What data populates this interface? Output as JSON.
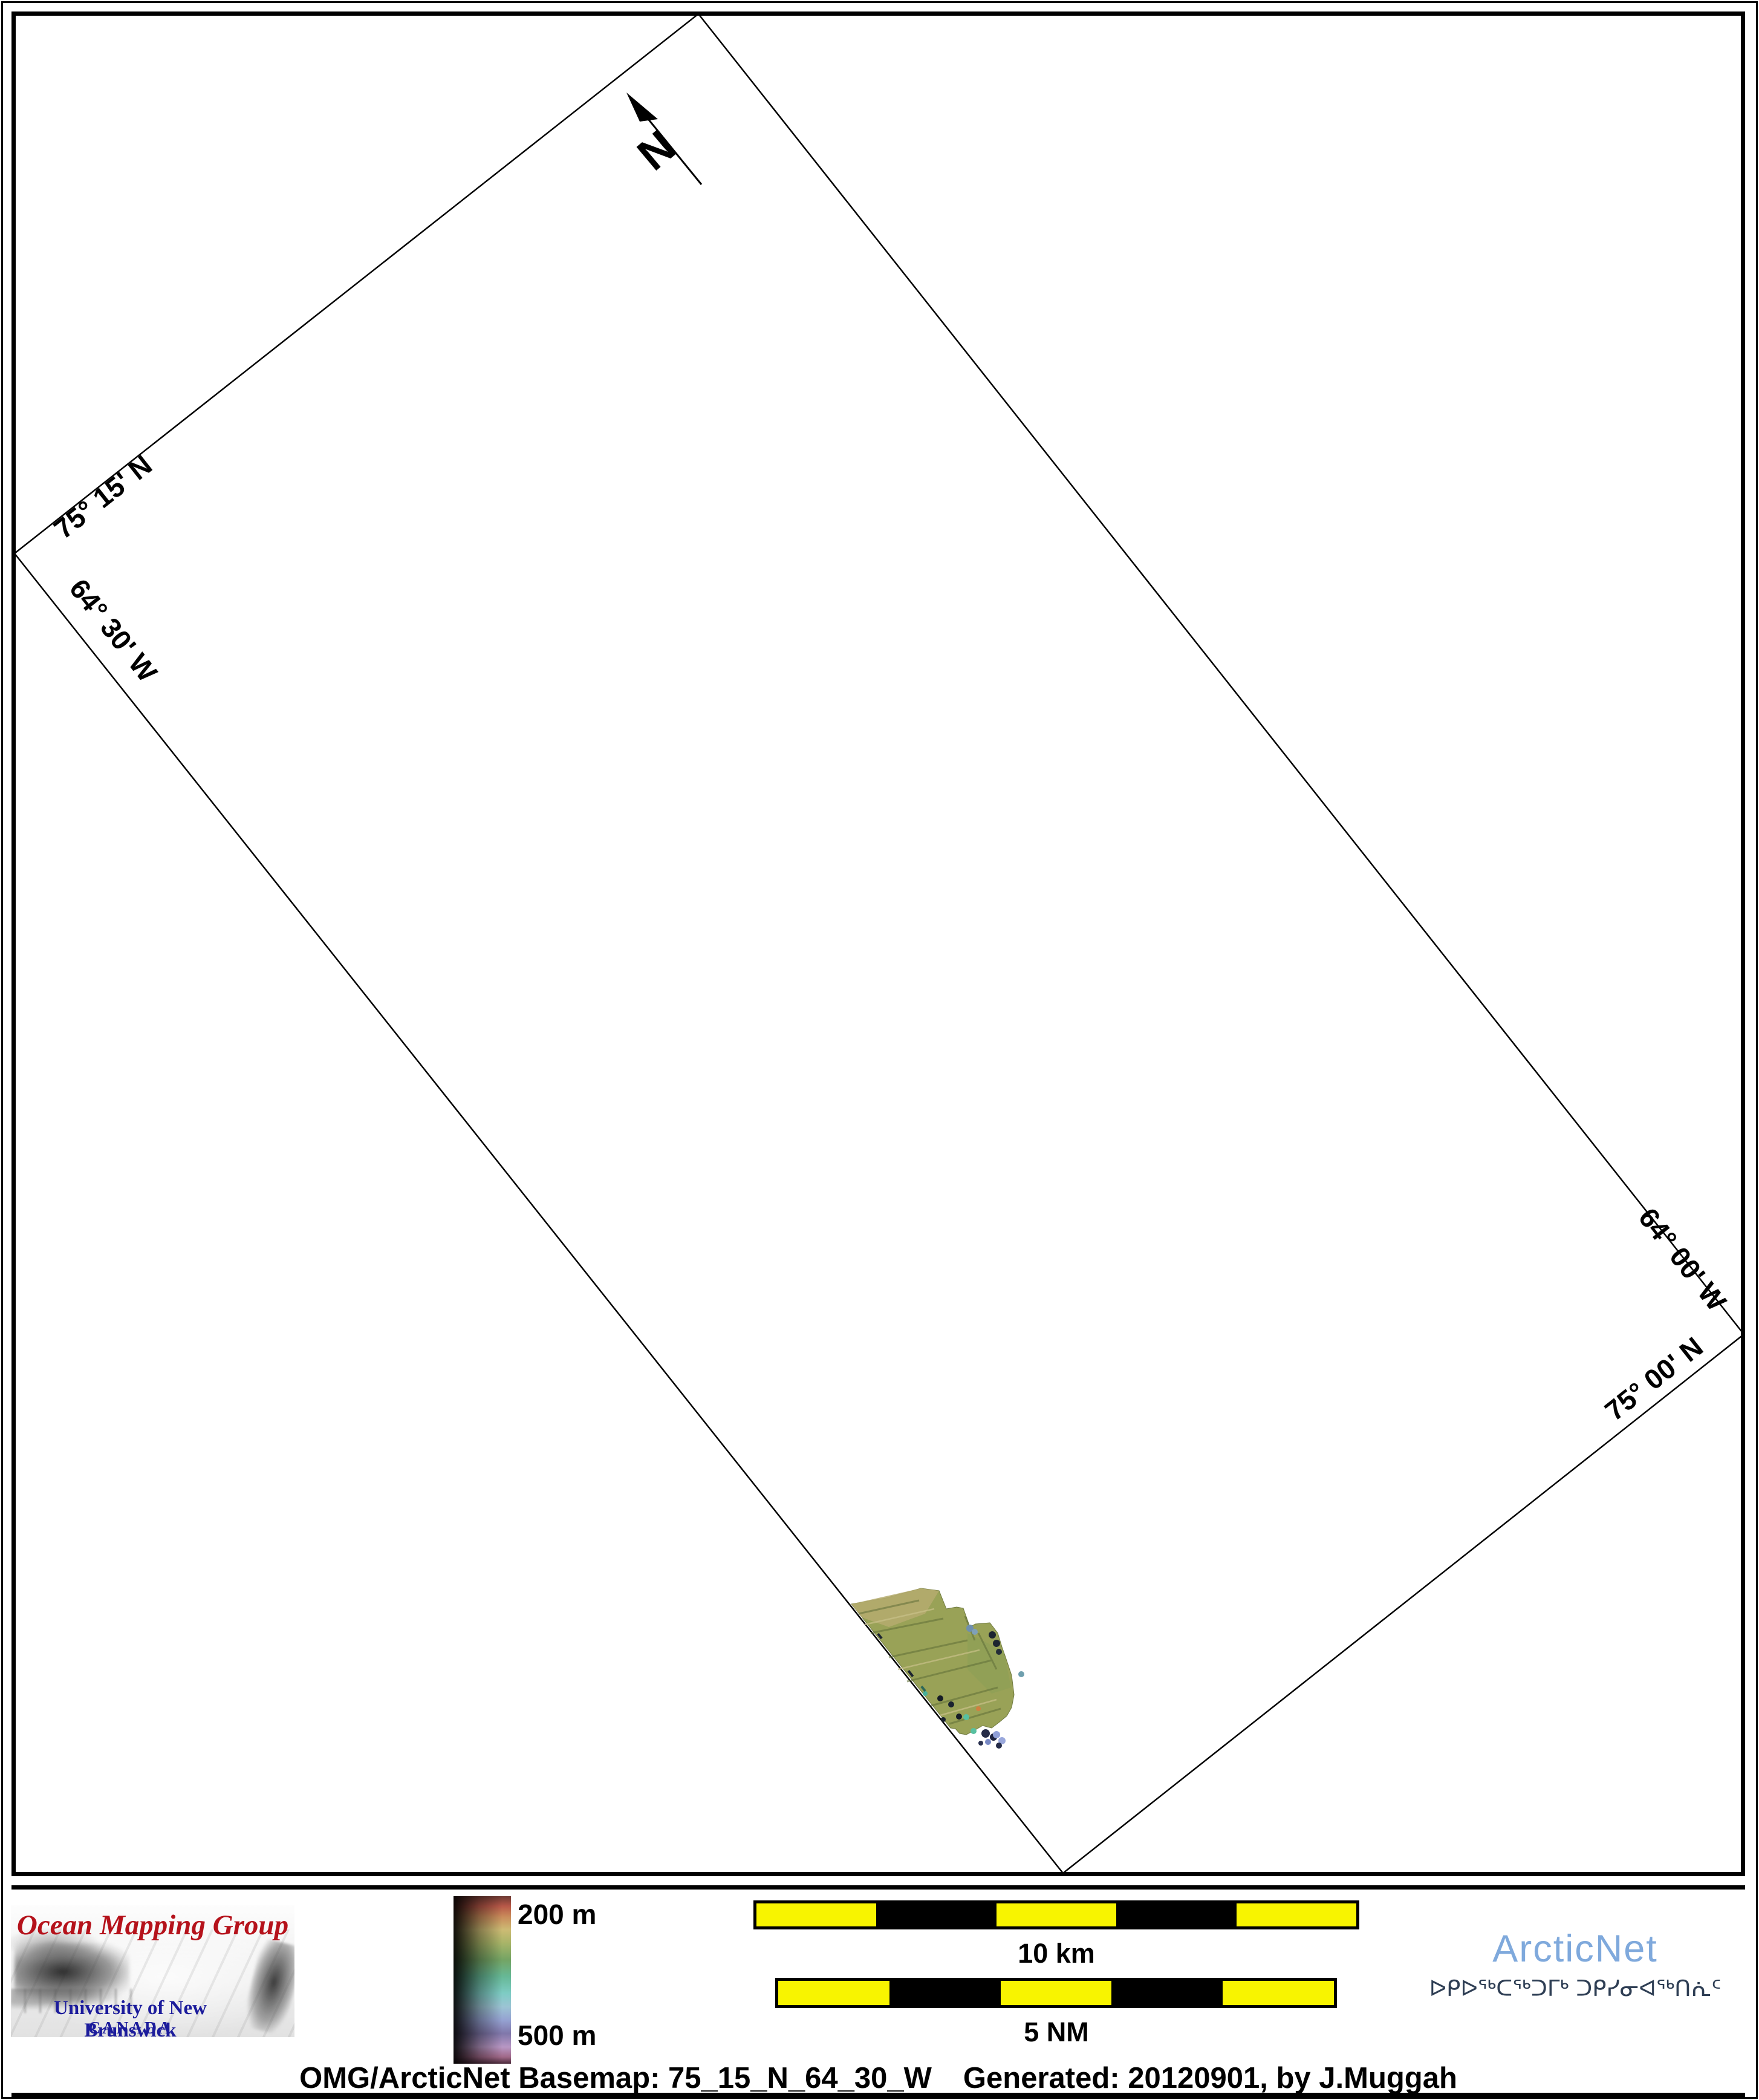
{
  "map": {
    "graticule_labels": [
      {
        "id": "top-left-lat",
        "text": "75° 15' N"
      },
      {
        "id": "left-lon",
        "text": "64° 30' W"
      },
      {
        "id": "right-lon",
        "text": "64° 00' W"
      },
      {
        "id": "bottom-right-lat",
        "text": "75° 00' N"
      }
    ],
    "north_label": "N",
    "feature": "multibeam-bathymetry-patch"
  },
  "legend": {
    "top_label": "200 m",
    "bottom_label": "500 m"
  },
  "scalebars": [
    {
      "label": "10 km",
      "segments": [
        "yellow",
        "black",
        "yellow",
        "black",
        "yellow"
      ]
    },
    {
      "label": "5 NM",
      "segments": [
        "yellow",
        "black",
        "yellow",
        "black",
        "yellow"
      ]
    }
  ],
  "omg_logo": {
    "title": "Ocean Mapping Group",
    "subtitle": "University of New Brunswick",
    "country": "CANADA"
  },
  "arcticnet": {
    "name": "ArcticNet",
    "inuktitut": "ᐅᑭᐅᖅᑕᖅᑐᒥᒃ ᑐᑭᓯᓂᐊᖅᑎᕇᑦ"
  },
  "caption": {
    "left": "OMG/ArcticNet Basemap: 75_15_N_64_30_W",
    "right": "Generated: 20120901, by J.Muggah"
  },
  "colors": {
    "scalebar_yellow": "#f8f400",
    "omg_red": "#b5121b",
    "omg_blue": "#1c1c9c",
    "arcticnet_blue": "#7fa9dc",
    "inuktitut_navy": "#2e3e54",
    "patch_olive": "#99a257"
  }
}
